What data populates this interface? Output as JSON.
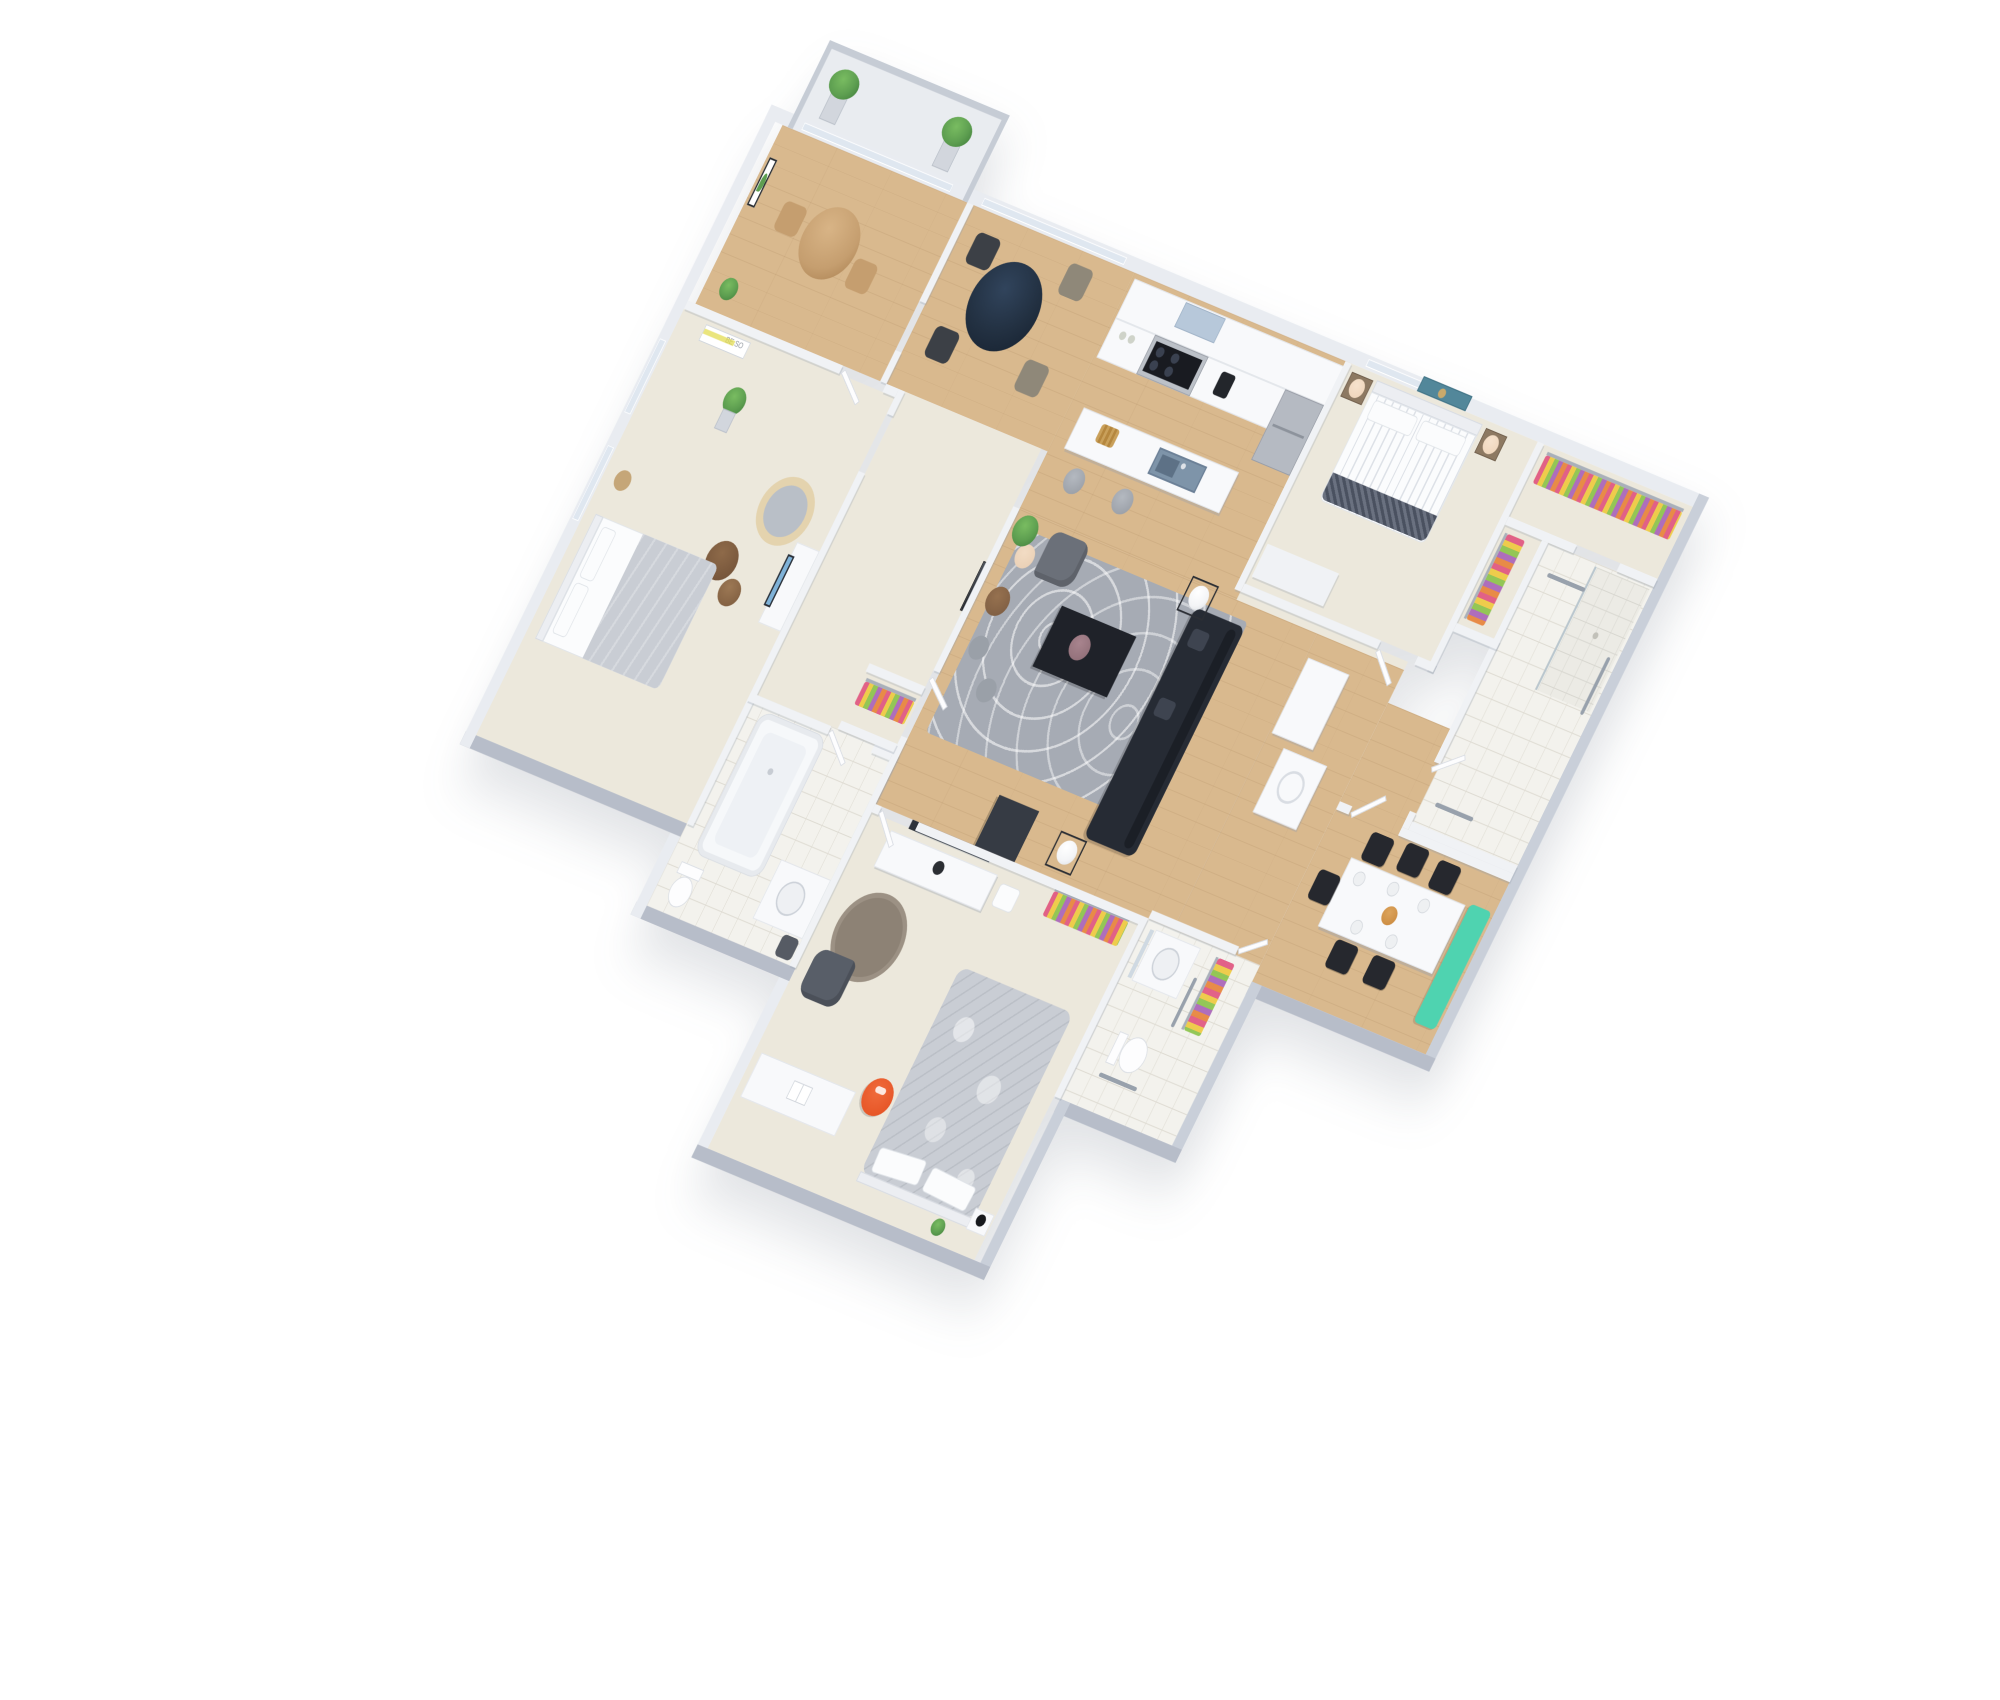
{
  "scene": {
    "type": "3d-floor-plan-render",
    "background": "#ffffff",
    "view": "isometric"
  },
  "poster": {
    "line1": "BE SO"
  },
  "colors": {
    "bg": "#ffffff",
    "wall-light": "#e9ecf1",
    "wall-mid": "#f0f2f5",
    "wall-edge": "#d6dae1",
    "wall-outer": "#b7bdc9",
    "wall-right": "#c9cfd9",
    "wood": "#d9b98e",
    "carpet": "#ece8dc",
    "tile": "#f3f2ed",
    "tile-line": "#dedbd2",
    "balcony-floor": "#e9ecf0",
    "railing": "#c6ccd5",
    "window": "#dfe7f0",
    "rug": "#a6abb4",
    "rug-round": "#8d8275",
    "sofa": "#262b34",
    "sofa-pillow": "#3e4450",
    "coffee-table": "#1f2229",
    "side-wire": "#2b2e34",
    "lamp-white": "#f3f4f6",
    "armchair": "#6b7079",
    "armchair-dark": "#585e68",
    "floor-lamp": "#e8cdb2",
    "pouf": "#9aa0a8",
    "tv-dark": "#2e333c",
    "tv-blue": "#7fb2d8",
    "round-table": "#223041",
    "chair-dark": "#3c4046",
    "chair-taupe": "#8f8879",
    "dining-chair": "#26282e",
    "bench-teal": "#4fd3b0",
    "plate": "#eef0f2",
    "platter": "#c8863a",
    "wood-furn": "#8a7258",
    "wood-light": "#c59e6f",
    "cabinet": "#f8f9fb",
    "cabinet-edge": "#e2e5ea",
    "steel": "#bcc1c8",
    "cooktop": "#191b21",
    "burner": "#3a4150",
    "sink": "#7e94a9",
    "sink-deep": "#5d7186",
    "stool": "#959aa2",
    "hood": "#b7c8da",
    "fridge": "#b5bac2",
    "bed-white": "#fbfcfd",
    "bed-stripe": "#dde1e7",
    "throw": "#4a5160",
    "headboard": "#eceef2",
    "night-wood": "#8d7962",
    "lamp-shade": "#eed3b8",
    "art-teal": "#52879a",
    "art-gold": "#c9a96b",
    "clothes-pink": "#e0557f",
    "clothes-yellow": "#eec93f",
    "clothes-green": "#8bc34a",
    "clothes-purple": "#a963b8",
    "clothes-orange": "#e7833a",
    "rod": "#a9b0ba",
    "duvet": "#c9cdd4",
    "papasan": "#e4d3ae",
    "papasan-cushion": "#b9bfc7",
    "plant": "#5d9e50",
    "plant-dark": "#3f7d3a",
    "planter": "#d2d6dd",
    "poster-yellow": "#e3dc52",
    "tub": "#f6f8fa",
    "fixture": "#fdfdfe",
    "fixture-edge": "#d9dde3",
    "grab": "#98a1ac",
    "red-chair": "#e34e1f",
    "desk": "#f9fafb",
    "door-leaf": "#fdfdfe"
  },
  "rooms": [
    {
      "id": "balcony",
      "furniture": [
        "railing",
        "tall-planter",
        "tall-planter"
      ]
    },
    {
      "id": "breakfast-nook",
      "furniture": [
        "round-wood-table",
        "wood-chair",
        "wood-chair",
        "monstera-art",
        "potted-plant"
      ]
    },
    {
      "id": "dining-bay",
      "furniture": [
        "round-black-table",
        "dark-chair",
        "taupe-chair",
        "dark-chair",
        "taupe-chair",
        "bay-windows"
      ]
    },
    {
      "id": "kitchen",
      "furniture": [
        "wall-cabinets",
        "range-hood",
        "gas-stove",
        "coffee-maker",
        "jars",
        "fridge",
        "island-with-sink",
        "fruit-basket",
        "bar-stool",
        "bar-stool"
      ]
    },
    {
      "id": "bedroom-1",
      "furniture": [
        "double-bed-striped",
        "headboard",
        "pillow",
        "pillow",
        "foot-throw",
        "nightstand",
        "nightstand",
        "table-lamp",
        "table-lamp",
        "teal-artwork",
        "window"
      ]
    },
    {
      "id": "walk-in-closet",
      "furniture": [
        "hanging-clothes",
        "rod"
      ]
    },
    {
      "id": "hall-closet",
      "furniture": [
        "hanging-clothes",
        "rod"
      ]
    },
    {
      "id": "bathroom-master",
      "furniture": [
        "walk-in-shower",
        "glass-panel",
        "grab-bar",
        "grab-bar",
        "grab-bar"
      ]
    },
    {
      "id": "living-room",
      "furniture": [
        "area-rug",
        "sectional-sofa",
        "sofa-pillow",
        "sofa-pillow",
        "coffee-table",
        "decor-bowl",
        "side-table-with-ball-lamp",
        "side-table-with-ball-lamp",
        "armchair",
        "floor-lamp",
        "round-side-table",
        "pouf",
        "pouf",
        "ficus-plant",
        "tv-pillar",
        "portrait-art"
      ]
    },
    {
      "id": "entry-hall",
      "furniture": [
        "pantry-cabinet",
        "washer"
      ]
    },
    {
      "id": "dining-room",
      "furniture": [
        "white-dining-table",
        "dining-chair",
        "dining-chair",
        "dining-chair",
        "dining-chair",
        "dining-chair",
        "dining-chair",
        "teal-bench",
        "place-setting",
        "place-setting",
        "place-setting",
        "place-setting",
        "place-setting",
        "center-platter"
      ]
    },
    {
      "id": "bedroom-2",
      "furniture": [
        "double-bed-gray-duvet",
        "pillow",
        "pillow",
        "papasan-chair",
        "nesting-tables",
        "snake-plant",
        "be-so-poster",
        "wood-stool",
        "tv-console-blue-screen",
        "windows"
      ]
    },
    {
      "id": "bathroom-1",
      "furniture": [
        "bathtub",
        "toilet",
        "vanity-sink",
        "dark-stool",
        "glass-shower"
      ]
    },
    {
      "id": "bedroom-3",
      "furniture": [
        "double-bed-fluffy",
        "pillow",
        "pillow",
        "desk",
        "open-book",
        "red-desk-chair",
        "swivel-armchair",
        "tv-console",
        "wall-tv",
        "round-rug",
        "cushion",
        "nightstand",
        "black-lamp",
        "small-plant",
        "closet-clothes"
      ]
    },
    {
      "id": "bathroom-2",
      "furniture": [
        "vanity-round-sink",
        "mirror",
        "toilet",
        "grab-bar",
        "grab-bar",
        "closet-clothes"
      ]
    }
  ]
}
